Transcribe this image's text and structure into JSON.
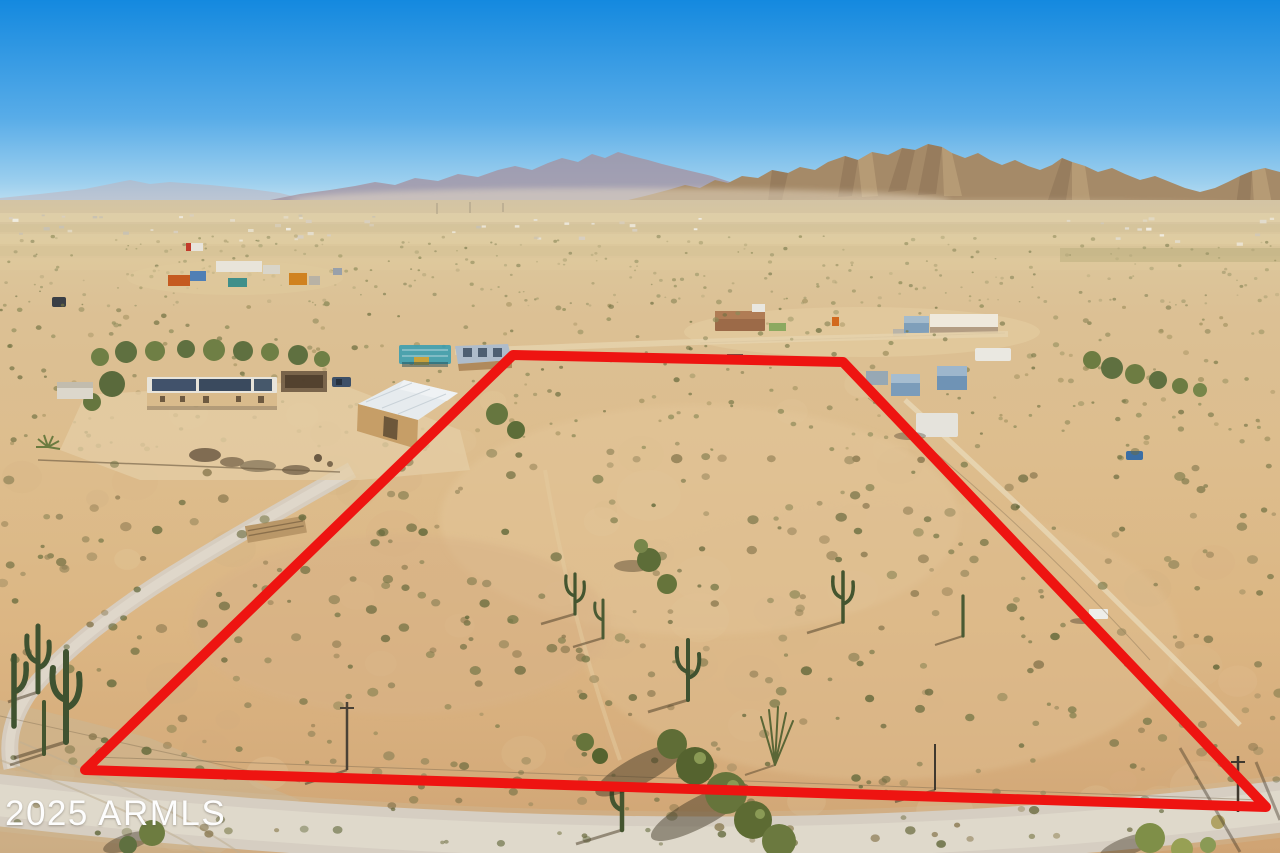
{
  "image": {
    "width": 1280,
    "height": 853,
    "kind": "aerial-drone-photo",
    "description": "Aerial view of a vacant Sonoran desert land parcel outlined with a red boundary line; homestead with solar-roof house and white metal barn at left, neighboring desert homes beyond, rocky mountain range on the horizon under a clear blue sky, dirt road across the foreground"
  },
  "watermark": {
    "text": "2025 ARMLS"
  },
  "boundary": {
    "label": "lot-boundary-outline",
    "points": "513,355 843,362 1266,807 85,770",
    "stroke_width": 10
  },
  "colors": {
    "sky_top": "#1489df",
    "sky_mid": "#58ace8",
    "sky_low": "#9ccfee",
    "sky_horizon": "#cde6f3",
    "mtn_far": "#bfb0b8",
    "mtn_mid": "#a493a3",
    "mtn_near": "#a58a68",
    "mtn_near_shade": "#8a7053",
    "mtn_near_lit": "#c7ab82",
    "plain": "#d9c49a",
    "sand": "#ddbb8c",
    "sand_deep": "#cfa373",
    "sand_light": "#e6cfa6",
    "road": "#d6cec2",
    "road_light": "#e1dacd",
    "trail": "#e8d8b6",
    "boundary_red": "#ee1411",
    "watermark_white": "#fdfdfd",
    "barn_roof": "#e6ebee",
    "barn_wall": "#c69e67",
    "house_wall": "#d9bb8c",
    "solar_panel": "#41526b",
    "container_orange": "#c55a20",
    "container_blue": "#4f7fb5",
    "container_teal": "#3f8f8a",
    "rv_white": "#eae8e1",
    "canopy_teal": "#3f9fb0",
    "blue_roof": "#aebccb"
  },
  "texture": {
    "regions": [
      {
        "layer": "scrub-far",
        "seed": 11,
        "x": 0,
        "y": 236,
        "w": 1280,
        "h": 70,
        "count": 320,
        "rmin": 0.7,
        "rmax": 1.8,
        "opacity": 0.55,
        "palette": [
          "#9a9668",
          "#7f7f52",
          "#b0a477",
          "#8c8a58"
        ]
      },
      {
        "layer": "scrub-mid",
        "seed": 23,
        "x": 0,
        "y": 300,
        "w": 1280,
        "h": 150,
        "count": 300,
        "rmin": 1.1,
        "rmax": 2.6,
        "opacity": 0.6,
        "palette": [
          "#8c8a58",
          "#6f7042",
          "#a39361",
          "#7a7a4a"
        ]
      },
      {
        "layer": "scrub-near",
        "seed": 37,
        "x": 0,
        "y": 450,
        "w": 1280,
        "h": 395,
        "count": 430,
        "rmin": 1.6,
        "rmax": 4.6,
        "opacity": 0.62,
        "palette": [
          "#7a7a4a",
          "#5f6638",
          "#93855a",
          "#6b6b3f",
          "#86754c"
        ]
      },
      {
        "layer": "sand-patches",
        "seed": 51,
        "x": 0,
        "y": 380,
        "w": 1280,
        "h": 460,
        "count": 70,
        "rmin": 9,
        "rmax": 26,
        "opacity": 0.16,
        "palette": [
          "#e9d4ab",
          "#d9b184",
          "#cfae80",
          "#e2c79c"
        ]
      },
      {
        "layer": "distant-structures",
        "seed": 63,
        "x": 4,
        "y": 214,
        "w": 730,
        "h": 26,
        "count": 46,
        "rmin": 0.9,
        "rmax": 2.0,
        "opacity": 0.9,
        "shape": "rect",
        "item": "distant-structure",
        "palette": [
          "#f0ece2",
          "#e6e0d2",
          "#d8cfc0",
          "#c9c2b2"
        ]
      },
      {
        "layer": "distant-structures",
        "seed": 77,
        "x": 1055,
        "y": 216,
        "w": 220,
        "h": 30,
        "count": 14,
        "rmin": 1.0,
        "rmax": 2.2,
        "opacity": 0.9,
        "shape": "rect",
        "item": "distant-structure",
        "palette": [
          "#f0ece2",
          "#e2dccc",
          "#d0c8b8"
        ]
      }
    ]
  }
}
